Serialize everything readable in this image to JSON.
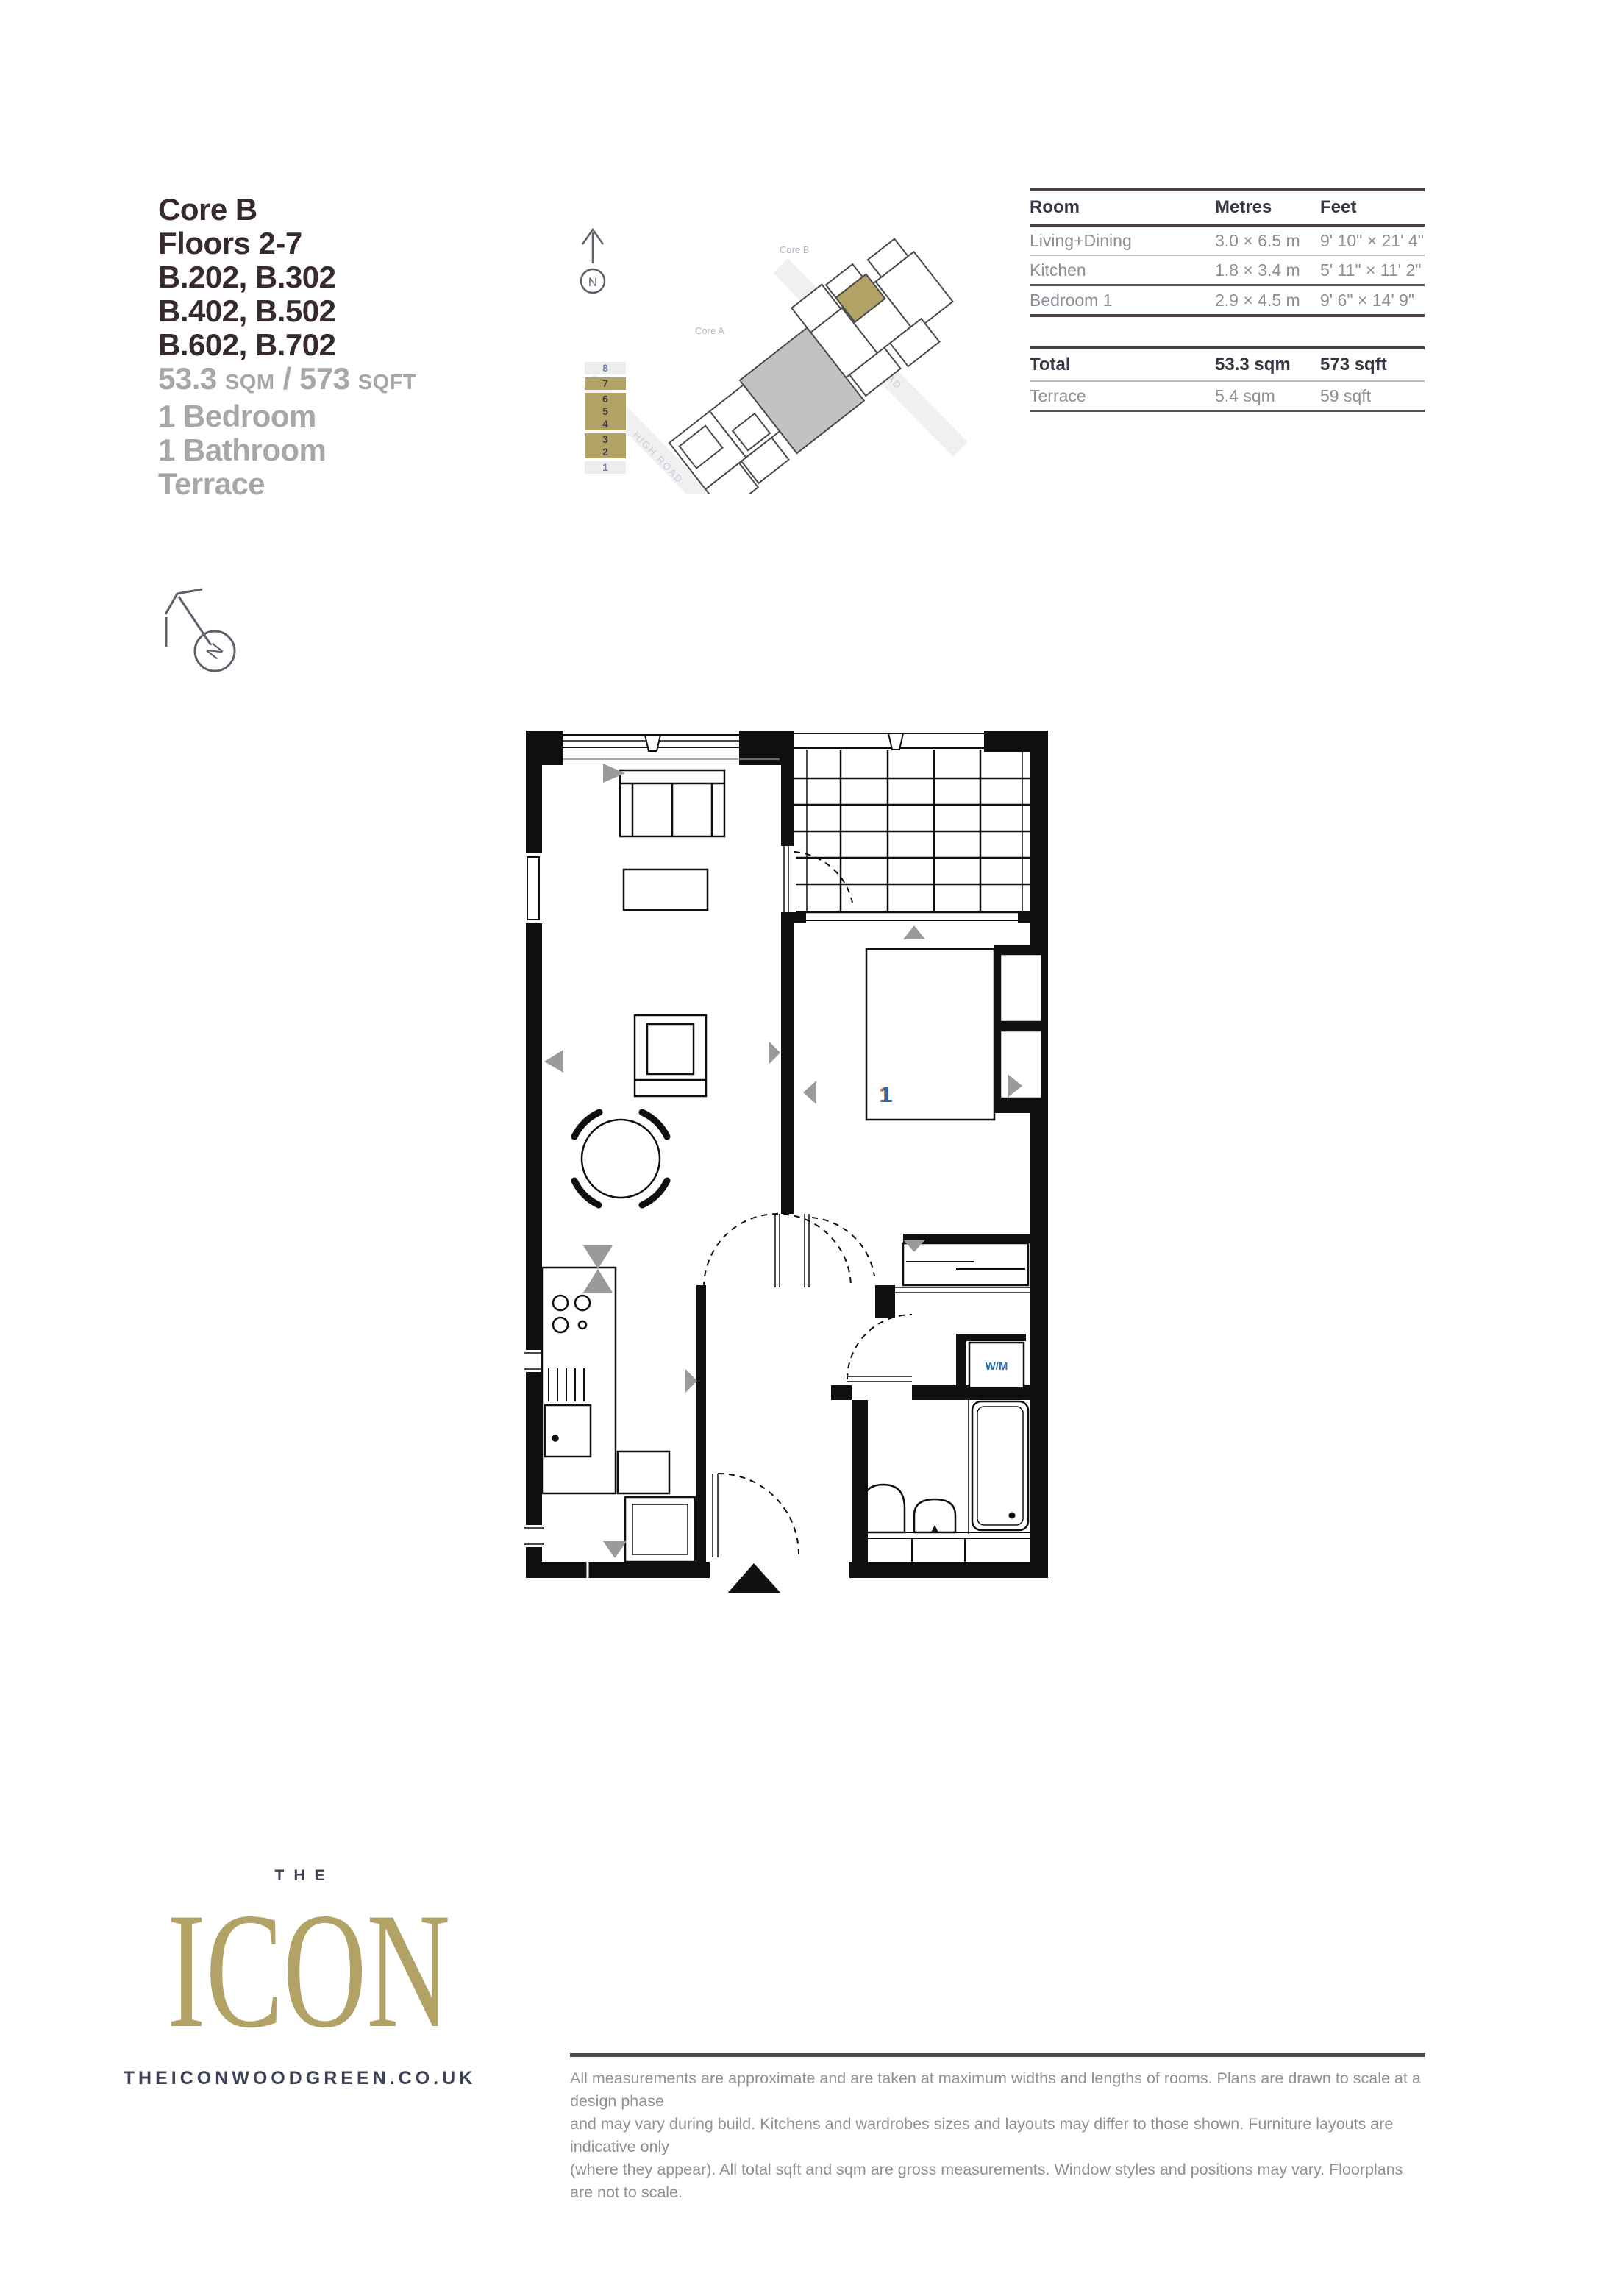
{
  "header": {
    "title_lines": [
      "Core B",
      "Floors 2-7",
      "B.202, B.302",
      "B.402, B.502",
      "B.602, B.702"
    ],
    "area_line": {
      "sqm_value": "53.3",
      "sqm_unit": "SQM",
      "separator": " / ",
      "sqft_value": "573",
      "sqft_unit": "SQFT"
    },
    "feature_lines": [
      "1 Bedroom",
      "1 Bathroom",
      "Terrace"
    ]
  },
  "site_plan": {
    "north_label": "N",
    "core_b_label": "Core B",
    "core_a_label": "Core A",
    "road_right_label": "BURY ROAD",
    "road_left_label": "HIGH ROAD",
    "floors": [
      {
        "label": "8",
        "highlight": false
      },
      {
        "label": "7",
        "highlight": true
      },
      {
        "label": "6",
        "highlight": true
      },
      {
        "label": "5",
        "highlight": true
      },
      {
        "label": "4",
        "highlight": true
      },
      {
        "label": "3",
        "highlight": true
      },
      {
        "label": "2",
        "highlight": true
      },
      {
        "label": "1",
        "highlight": false
      }
    ]
  },
  "dimensions_table": {
    "columns": [
      "Room",
      "Metres",
      "Feet"
    ],
    "rows": [
      {
        "room": "Living+Dining",
        "metres": "3.0 × 6.5 m",
        "feet": "9' 10\" × 21' 4\""
      },
      {
        "room": "Kitchen",
        "metres": "1.8 × 3.4 m",
        "feet": "5' 11\" × 11' 2\""
      },
      {
        "room": "Bedroom 1",
        "metres": "2.9 × 4.5 m",
        "feet": "9' 6\" × 14' 9\""
      }
    ],
    "total": {
      "room": "Total",
      "metres": "53.3 sqm",
      "feet": "573 sqft"
    },
    "terrace": {
      "room": "Terrace",
      "metres": "5.4 sqm",
      "feet": "59 sqft"
    }
  },
  "floor_plan": {
    "compass_label": "N",
    "bedroom_number": "1",
    "washing_machine_label": "W/M"
  },
  "footer": {
    "logo_top": "THE",
    "logo_main": "ICON",
    "website": "THEICONWOODGREEN.CO.UK",
    "disclaimer_lines": [
      "All measurements are approximate and are taken at maximum widths and lengths of rooms. Plans are drawn to scale at a design phase",
      "and may vary during build. Kitchens and wardrobes sizes and layouts may differ to those shown. Furniture layouts are indicative only",
      "(where they appear). All total sqft and sqm are gross measurements. Window styles and positions may vary. Floorplans are not to scale."
    ]
  },
  "colors": {
    "gold": "#b3a266",
    "ink": "#362a2e",
    "muted_gray": "#a7a7a9",
    "table_ink": "#3b3543",
    "table_muted": "#8e8e96",
    "plan_ink": "#0f0f0f",
    "marker_gray": "#9a9a9a",
    "bed_label_blue": "#2e66a8",
    "wm_label_blue": "#2b6cb0",
    "site_label_blue": "#aab8c7",
    "url_ink": "#3e4156"
  }
}
